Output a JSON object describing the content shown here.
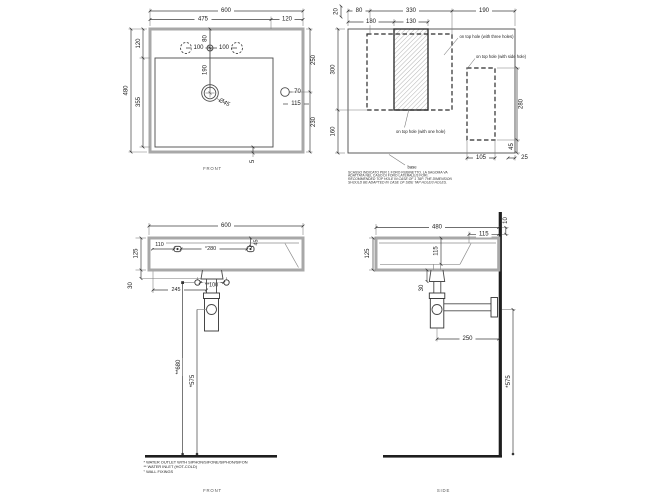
{
  "sheet": {
    "background": "#ffffff",
    "colors": {
      "wall_gray": "#a8a8a8",
      "line": "#3f3f3f",
      "heavy": "#1e1e1e"
    }
  },
  "views": {
    "plan": {
      "label": "FRONT",
      "dims": {
        "width": "600",
        "bowl_width": "475",
        "deck_width": "120",
        "rim_depth": "120",
        "height": "480",
        "bowl_height": "355",
        "top_to_overflow": "250",
        "overflow_to_bottom": "230",
        "tap_inset": "80",
        "tap_pitch_left": "100",
        "tap_pitch_right": "100",
        "tap_to_drain": "190",
        "drain_diameter": "Ø45",
        "overflow_diameter": "70",
        "overflow_inset": "115",
        "bottom_wall": "5"
      }
    },
    "template": {
      "dims": {
        "top_offset": "20",
        "left_to_cutout": "80",
        "cutout_span": "330",
        "right_span": "190",
        "left_to_hatch": "180",
        "hatch_width": "130",
        "cutout_height": "300",
        "below_cutout": "160",
        "side_cutout_height": "280",
        "side_cutout_bottom": "45",
        "side_cutout_width": "105",
        "side_cutout_edge": "25"
      },
      "labels": {
        "three_holes": "on top hole (with three holes)",
        "side_hole": "on top hole (with side hole)",
        "one_hole": "on top hole (with one hole)",
        "base": "base"
      },
      "caption": {
        "it1": "SCASSO INDICATO PER 1 FORO RUBINETTO. LA SAGOMA VA",
        "it2": "ADATTATA NEL CASO DI FORO LATERALE/3 FORI.",
        "en1": "RECOMMENDED TOP HOLE IN CASE OF 1 TAP. THE DIMENSION",
        "en2": "SHOULD BE ADAPTED IN CASE OF SIDE TAP HOLE/3 HOLES."
      }
    },
    "front_elevation": {
      "label": "FRONT",
      "dims": {
        "width": "600",
        "rim_height": "125",
        "apron": "30",
        "fixing_left": "110",
        "fixing_pitch": "°280",
        "fixing_drop": "45",
        "drain_offset": "245",
        "inlet_pitch": "**100",
        "inlet_height": "**680",
        "outlet_height": "*575"
      },
      "footnotes": {
        "f1": "* WATER OUTLET WITH SIPHON/SIFONE/SIPHON/SIFON",
        "f2": "** WATER INLET  (HOT-COLD)",
        "f3": "° WALL FIXINGS"
      }
    },
    "side_elevation": {
      "label": "SIDE",
      "dims": {
        "depth": "480",
        "back_deck": "115",
        "wall_gap": "10",
        "rim_height": "125",
        "bowl_depth": "115",
        "apron": "30",
        "trap_reach": "250",
        "outlet_height": "*575"
      }
    }
  }
}
